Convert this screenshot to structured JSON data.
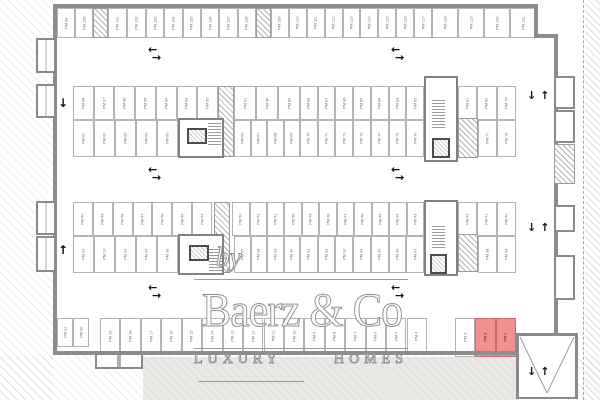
{
  "watermark": {
    "prefix": "by",
    "brand": "Baerz & Co",
    "tagline_word1": "LUXURY",
    "tagline_word2": "HOMES"
  },
  "colors": {
    "plan_line": "#b3b3b3",
    "wall": "#8d8d8d",
    "highlight_fill": "#f19093",
    "highlight_border": "#cf696c",
    "label_text": "#6e6e6e",
    "watermark_stroke": "#8f8f8f"
  },
  "icons": {
    "arrow-left": "←",
    "arrow-right": "→",
    "arrow-up": "↑",
    "arrow-down": "↓"
  },
  "stall_rows": [
    {
      "y": 8,
      "h": 30,
      "segments": [
        {
          "x1": 57,
          "x2": 93,
          "labels": [
            "PM 99",
            "PM 100"
          ]
        },
        {
          "x1": 108,
          "x2": 146,
          "labels": [
            "PM 101",
            "PM 102"
          ]
        },
        {
          "x1": 146,
          "x2": 256,
          "labels": [
            "PM 103",
            "PM 104",
            "PM 105",
            "PM 106",
            "PM 107",
            "PM 108"
          ]
        },
        {
          "x1": 271,
          "x2": 432,
          "labels": [
            "PM 109",
            "PM 110",
            "PM 111",
            "PM 112",
            "PM 113",
            "PM 114",
            "PM 115",
            "PM 116",
            "PM 117"
          ]
        },
        {
          "x1": 432,
          "x2": 536,
          "labels": [
            "PM 118",
            "PM 119",
            "PM 120",
            "PM 121"
          ]
        }
      ]
    },
    {
      "y": 86,
      "h": 34,
      "segments": [
        {
          "x1": 73,
          "x2": 218,
          "labels": [
            "PM 98",
            "PM 97",
            "PM 96",
            "PM 95",
            "PM 94",
            "PM 93",
            "PM 92"
          ]
        },
        {
          "x1": 234,
          "x2": 300,
          "labels": [
            "PM 91",
            "PM 90",
            "PM 89"
          ]
        },
        {
          "x1": 300,
          "x2": 424,
          "labels": [
            "PM 88",
            "PM 87",
            "PM 86",
            "PM 85",
            "PM 84",
            "PM 83",
            "PM 82"
          ]
        },
        {
          "x1": 458,
          "x2": 516,
          "labels": [
            "PM 81",
            "PM 80",
            "PM 79"
          ]
        }
      ]
    },
    {
      "y": 120,
      "h": 37,
      "segments": [
        {
          "x1": 73,
          "x2": 178,
          "labels": [
            "PM 61",
            "PM 62",
            "PM 63",
            "PM 64",
            "PM 65"
          ]
        },
        {
          "x1": 234,
          "x2": 300,
          "labels": [
            "PM 66",
            "PM 67",
            "PM 68",
            "PM 69"
          ]
        },
        {
          "x1": 300,
          "x2": 424,
          "labels": [
            "PM 70",
            "PM 71",
            "PM 72",
            "PM 73",
            "PM 74",
            "PM 75",
            "PM 76"
          ]
        },
        {
          "x1": 478,
          "x2": 516,
          "labels": [
            "PM 77",
            "PM 78"
          ]
        }
      ]
    },
    {
      "y": 202,
      "h": 34,
      "segments": [
        {
          "x1": 73,
          "x2": 212,
          "labels": [
            "PM 60",
            "PM 59",
            "PM 58",
            "PM 57",
            "PM 56",
            "PM 55",
            "PM 54"
          ]
        },
        {
          "x1": 232,
          "x2": 424,
          "labels": [
            "PM 53",
            "PM 52",
            "PM 51",
            "PM 50",
            "PM 49",
            "PM 48",
            "PM 47",
            "PM 46",
            "PM 45",
            "PM 44",
            "PM 43"
          ]
        },
        {
          "x1": 458,
          "x2": 516,
          "labels": [
            "PM 42",
            "PM 41",
            "PM 40"
          ]
        }
      ]
    },
    {
      "y": 236,
      "h": 37,
      "segments": [
        {
          "x1": 73,
          "x2": 178,
          "labels": [
            "PM 22",
            "PM 23",
            "PM 24",
            "PM 25",
            "PM 26"
          ]
        },
        {
          "x1": 234,
          "x2": 300,
          "labels": [
            "PM 27",
            "PM 28",
            "PM 29",
            "PM 30"
          ]
        },
        {
          "x1": 300,
          "x2": 424,
          "labels": [
            "PM 31",
            "PM 32",
            "PM 33",
            "PM 34",
            "PM 35",
            "PM 36",
            "PM 37"
          ]
        },
        {
          "x1": 478,
          "x2": 516,
          "labels": [
            "PM 38",
            "PM 39"
          ]
        }
      ]
    },
    {
      "y": 318,
      "h": 36,
      "segments": [
        {
          "x1": 57,
          "x2": 89,
          "h": 29,
          "labels": [
            "PM 21",
            "PM 20"
          ]
        },
        {
          "x1": 100,
          "x2": 427,
          "labels": [
            "PM 19",
            "PM 18",
            "PM 17",
            "PM 16",
            "PM 15",
            "PM 14",
            "PM 13",
            "PM 12",
            "PM 11",
            "PM 10",
            "PM 9",
            "PM 8",
            "PM 7",
            "PM 6",
            "PM 5",
            "PM 4"
          ]
        },
        {
          "x1": 455,
          "x2": 475,
          "h": 39,
          "labels": [
            "PM 3"
          ]
        },
        {
          "x1": 475,
          "x2": 516,
          "h": 39,
          "highlight": true,
          "labels": [
            "PM 2",
            "PM 1"
          ]
        }
      ]
    }
  ],
  "arrows": [
    {
      "x": 148,
      "y": 46,
      "type": "pair-h"
    },
    {
      "x": 391,
      "y": 46,
      "type": "pair-h"
    },
    {
      "x": 148,
      "y": 166,
      "type": "pair-h"
    },
    {
      "x": 391,
      "y": 166,
      "type": "pair-h"
    },
    {
      "x": 148,
      "y": 284,
      "type": "pair-h"
    },
    {
      "x": 391,
      "y": 284,
      "type": "pair-h"
    },
    {
      "x": 58,
      "y": 97,
      "type": "down"
    },
    {
      "x": 58,
      "y": 244,
      "type": "up"
    },
    {
      "x": 527,
      "y": 90,
      "type": "pair-v"
    },
    {
      "x": 527,
      "y": 222,
      "type": "pair-v"
    },
    {
      "x": 527,
      "y": 366,
      "type": "pair-v"
    }
  ]
}
